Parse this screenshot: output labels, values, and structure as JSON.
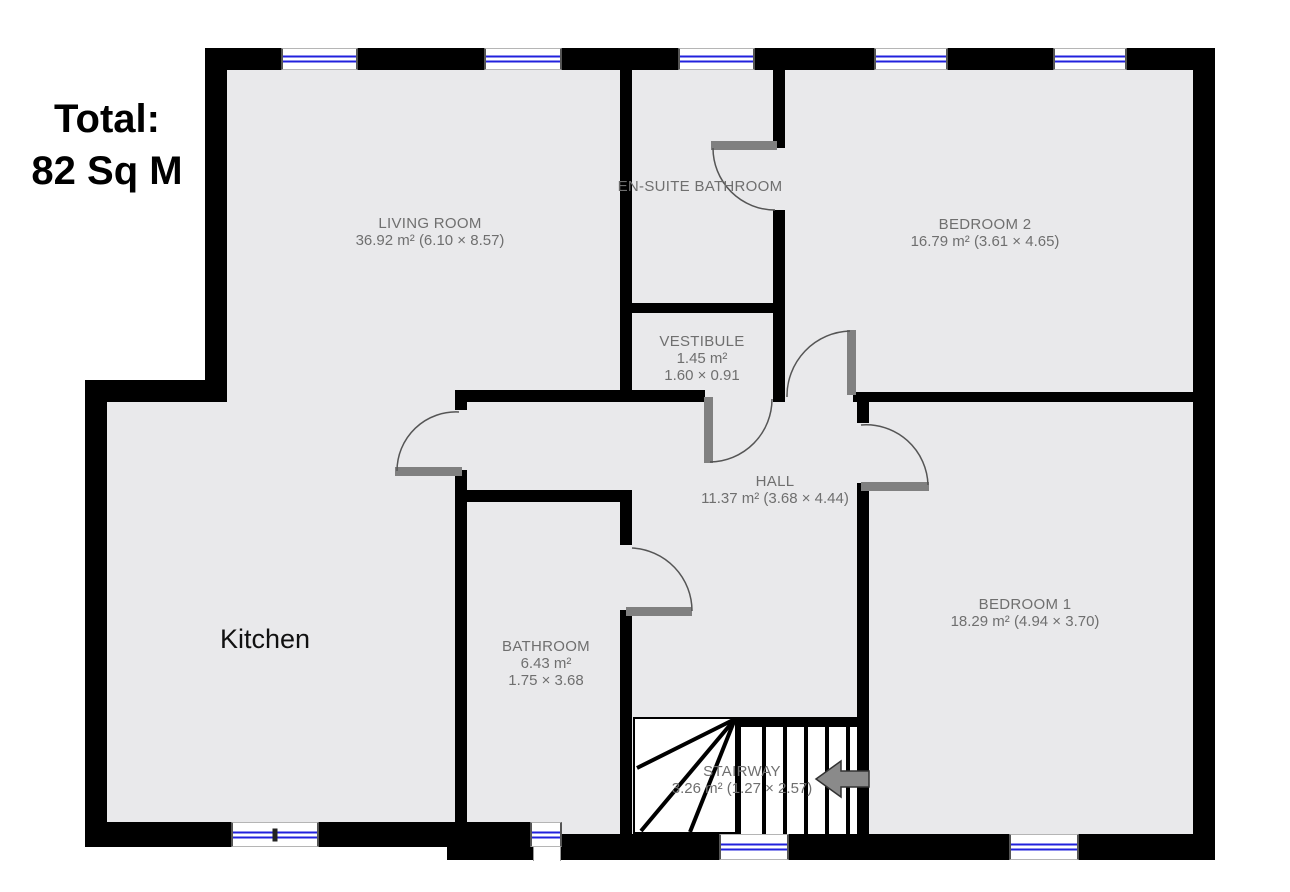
{
  "title": "Floor plan",
  "total": {
    "line1": "Total:",
    "line2": "82 Sq M"
  },
  "rooms": {
    "living_room": {
      "name": "LIVING ROOM",
      "dims": "36.92 m² (6.10 × 8.57)"
    },
    "en_suite": {
      "name": "EN-SUITE BATHROOM"
    },
    "bedroom2": {
      "name": "BEDROOM 2",
      "dims": "16.79 m² (3.61 × 4.65)"
    },
    "vestibule": {
      "name": "VESTIBULE",
      "area": "1.45 m²",
      "dims": "1.60 × 0.91"
    },
    "hall": {
      "name": "HALL",
      "dims": "11.37 m² (3.68 × 4.44)"
    },
    "bedroom1": {
      "name": "BEDROOM 1",
      "dims": "18.29 m² (4.94 × 3.70)"
    },
    "bathroom": {
      "name": "BATHROOM",
      "area": "6.43 m²",
      "dims": "1.75 × 3.68"
    },
    "stairway": {
      "name": "STAIRWAY",
      "dims": "3.26 m² (1.27 × 2.57)"
    },
    "kitchen": {
      "name": "Kitchen"
    }
  },
  "icons": {
    "stair_arrow": "left-arrow"
  },
  "colors": {
    "wall": "#000000",
    "floor": "#e9e9eb",
    "window_glass": "#2121dd",
    "door": "#808080",
    "label": "#6f6f6f"
  }
}
